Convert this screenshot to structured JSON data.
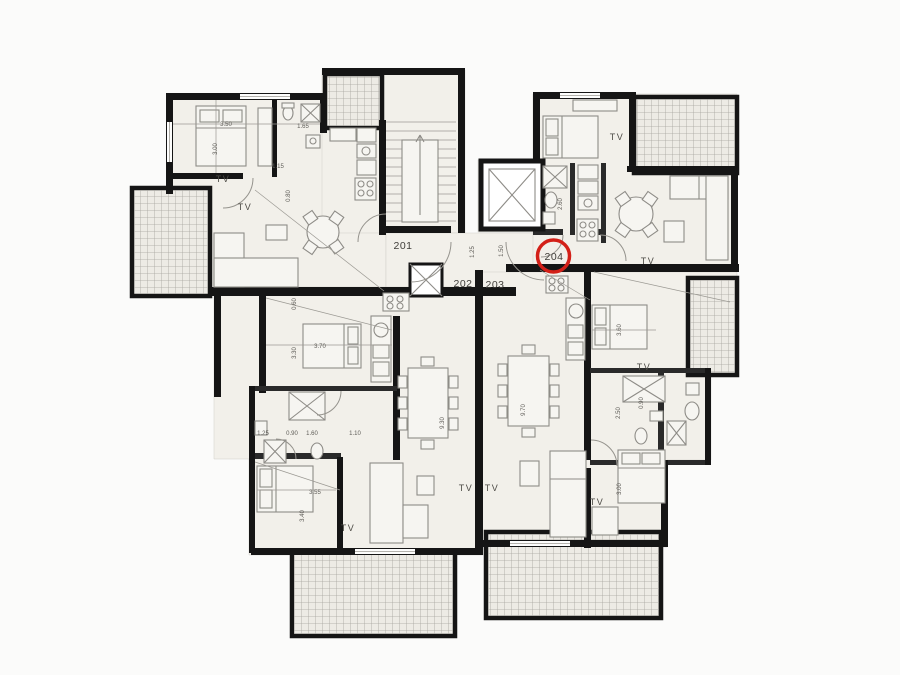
{
  "page": {
    "background": "#fbfbfa"
  },
  "plan": {
    "type": "architectural-floor-plan",
    "floor_color": "#f2f0ea",
    "wall_color": "#151515",
    "furniture_color": "#8e8c87",
    "highlight_color": "#d32018",
    "tv_text": "TV",
    "unit_labels": [
      {
        "id": "201",
        "text": "201",
        "x": 403,
        "y": 249
      },
      {
        "id": "202",
        "text": "202",
        "x": 463,
        "y": 287
      },
      {
        "id": "203",
        "text": "203",
        "x": 495,
        "y": 288
      },
      {
        "id": "204",
        "text": "204",
        "x": 554,
        "y": 260,
        "highlight": {
          "cx": 553.5,
          "cy": 256,
          "r": 16
        }
      }
    ],
    "tv_labels": [
      {
        "x": 223,
        "y": 182
      },
      {
        "x": 245,
        "y": 210
      },
      {
        "x": 617,
        "y": 140
      },
      {
        "x": 648,
        "y": 264
      },
      {
        "x": 644,
        "y": 370
      },
      {
        "x": 348,
        "y": 531
      },
      {
        "x": 466,
        "y": 491
      },
      {
        "x": 492,
        "y": 491
      },
      {
        "x": 597,
        "y": 505
      }
    ],
    "dimension_labels": [
      {
        "text": "3.50",
        "x": 226,
        "y": 126,
        "rot": 0
      },
      {
        "text": "3.00",
        "x": 217,
        "y": 149,
        "rot": -90
      },
      {
        "text": "1.65",
        "x": 303,
        "y": 128,
        "rot": 0
      },
      {
        "text": "1.15",
        "x": 278,
        "y": 168,
        "rot": 0
      },
      {
        "text": "0.80",
        "x": 290,
        "y": 196,
        "rot": -90
      },
      {
        "text": "0.60",
        "x": 296,
        "y": 304,
        "rot": -90
      },
      {
        "text": "1.25",
        "x": 474,
        "y": 252,
        "rot": -90
      },
      {
        "text": "1.50",
        "x": 503,
        "y": 251,
        "rot": -90
      },
      {
        "text": "2.60",
        "x": 562,
        "y": 204,
        "rot": -90
      },
      {
        "text": "3.70",
        "x": 320,
        "y": 348,
        "rot": 0
      },
      {
        "text": "3.30",
        "x": 296,
        "y": 353,
        "rot": -90
      },
      {
        "text": "9.30",
        "x": 444,
        "y": 423,
        "rot": -90
      },
      {
        "text": "9.70",
        "x": 525,
        "y": 410,
        "rot": -90
      },
      {
        "text": "3.60",
        "x": 621,
        "y": 330,
        "rot": -90
      },
      {
        "text": "2.50",
        "x": 620,
        "y": 413,
        "rot": -90
      },
      {
        "text": "0.90",
        "x": 643,
        "y": 403,
        "rot": -90
      },
      {
        "text": "3.55",
        "x": 315,
        "y": 494,
        "rot": 0
      },
      {
        "text": "3.40",
        "x": 304,
        "y": 516,
        "rot": -90
      },
      {
        "text": "3.00",
        "x": 621,
        "y": 489,
        "rot": -90
      },
      {
        "text": "1.25",
        "x": 263,
        "y": 435,
        "rot": 0
      },
      {
        "text": "0.90",
        "x": 292,
        "y": 435,
        "rot": 0
      },
      {
        "text": "1.60",
        "x": 312,
        "y": 435,
        "rot": 0
      },
      {
        "text": "1.10",
        "x": 355,
        "y": 435,
        "rot": 0
      }
    ]
  }
}
